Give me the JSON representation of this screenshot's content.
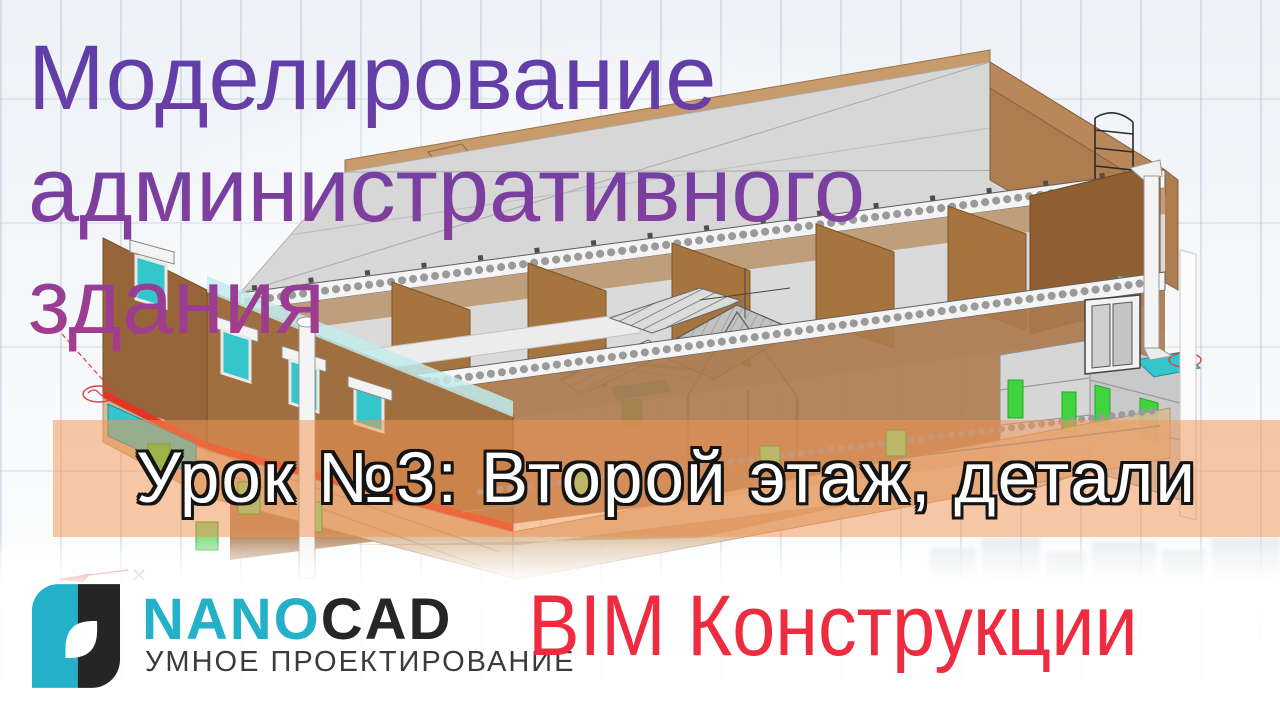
{
  "title": {
    "lines": [
      "Моделирование",
      "административного",
      "здания"
    ]
  },
  "lesson_banner": {
    "label": "Урок №3: Второй этаж, детали"
  },
  "branding": {
    "logo": {
      "name_primary": "NANO",
      "name_secondary": "CAD",
      "tagline": "УМНОЕ ПРОЕКТИРОВАНИЕ"
    },
    "product_label": "BIM Конструкции"
  },
  "illustration": {
    "description": "Isometric BIM cutaway model of a two-storey administrative building: grey roof and hollow-core floor slabs, brown partition walls, teal windows, green masonry blocks, entrance stair with canopy, drain pipes, red slab-level stripe and red CAD annotations",
    "icons": [
      "building-model",
      "axis-bubble-annotation",
      "sketch-arrow",
      "cross-marker"
    ]
  },
  "colors": {
    "title_gradient_top": "#5a3dab",
    "title_gradient_bottom": "#aa3c8a",
    "banner_overlay": "rgba(244,149,85,0.52)",
    "banner_text": "#ffffff",
    "banner_outline": "#141414",
    "logo_teal": "#22b1c9",
    "logo_dark": "#262626",
    "bim_red": "#ee2b3f",
    "wall_brown": "#a5743f",
    "slab_grey": "#d8d8d8",
    "window_teal": "#35c6cc",
    "block_green": "#3ed43e",
    "stripe_red": "#e63322"
  }
}
